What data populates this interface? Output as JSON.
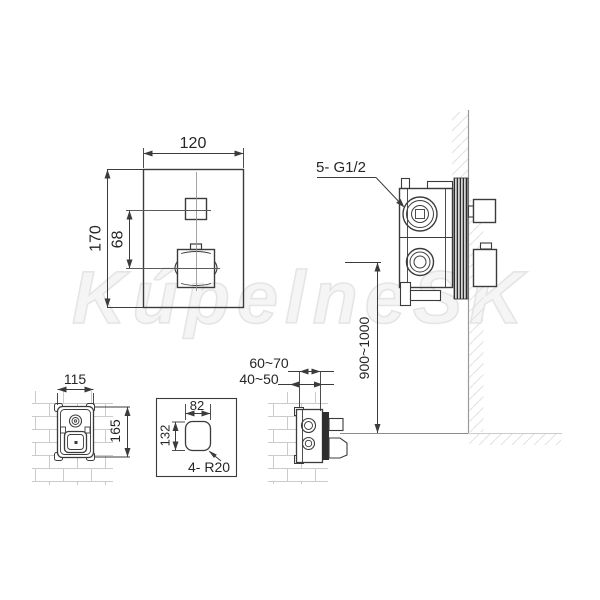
{
  "watermark": "KúpelneSK",
  "front_view": {
    "width": "120",
    "height": "170",
    "handle_spacing": "68"
  },
  "side_view": {
    "connection_label": "5- G1/2",
    "install_height": "900~1000"
  },
  "rough_in_view": {
    "width": "115",
    "height": "165"
  },
  "cutout_view": {
    "width": "82",
    "height": "132",
    "corner_radius": "4- R20"
  },
  "depth_view": {
    "max_depth": "60~70",
    "min_depth": "40~50"
  }
}
